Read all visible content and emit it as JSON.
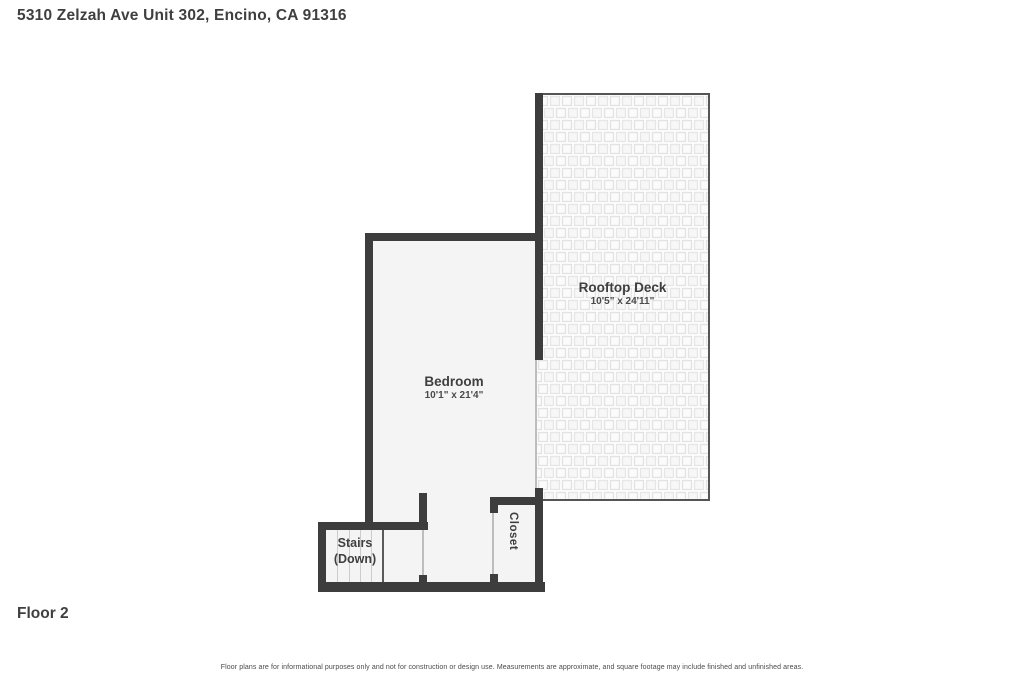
{
  "header": {
    "address": "5310 Zelzah Ave Unit 302, Encino, CA 91316"
  },
  "floor": {
    "label": "Floor 2"
  },
  "rooms": {
    "rooftop_deck": {
      "name": "Rooftop Deck",
      "dimensions": "10'5\" x 24'11\""
    },
    "bedroom": {
      "name": "Bedroom",
      "dimensions": "10'1\" x 21'4\""
    },
    "stairs": {
      "name_line1": "Stairs",
      "name_line2": "(Down)"
    },
    "closet": {
      "name": "Closet"
    }
  },
  "footer": {
    "disclaimer": "Floor plans are for informational purposes only and not for construction or design use. Measurements are approximate, and square footage may include finished and unfinished areas."
  },
  "colors": {
    "wall": "#3d3d3d",
    "floor_fill": "#f4f4f4",
    "text": "#3f3f3f",
    "deck_tile_outline": "#e2e2e2",
    "door_line": "#bdbdbd"
  }
}
